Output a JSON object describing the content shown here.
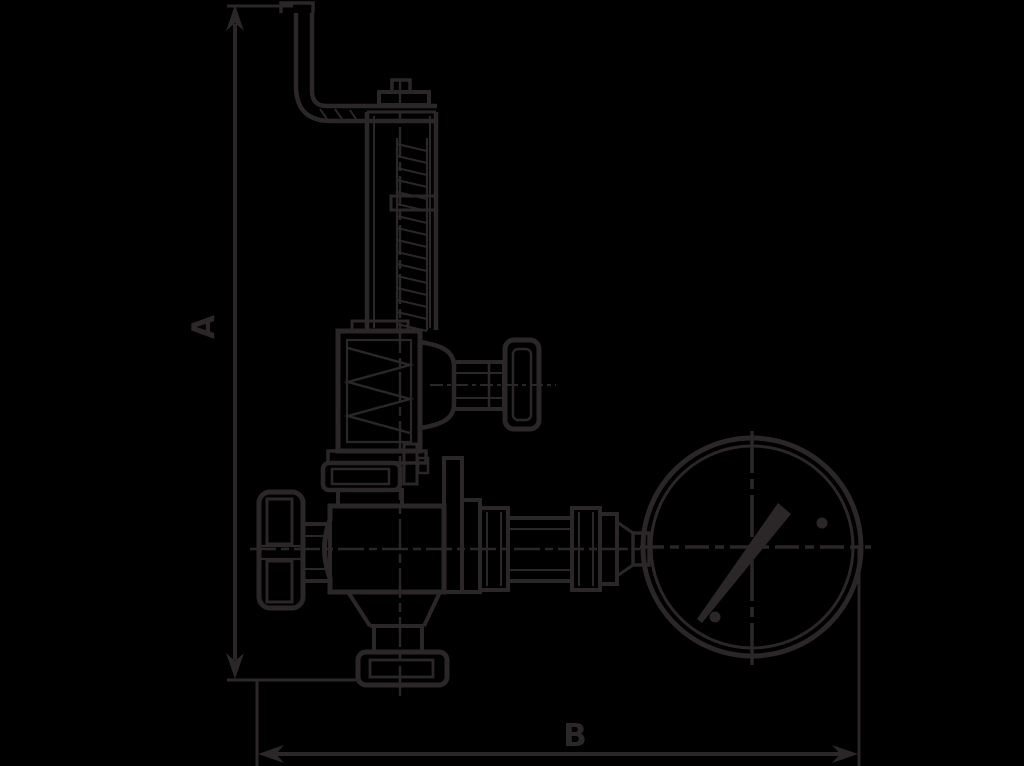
{
  "diagram": {
    "type": "technical-line-drawing",
    "subject": "relief valve with lever, handwheel and pressure gauge",
    "labels": {
      "dimension_a": "A",
      "dimension_b": "B"
    },
    "colors": {
      "background": "#000000",
      "line": "#2b2627"
    }
  }
}
